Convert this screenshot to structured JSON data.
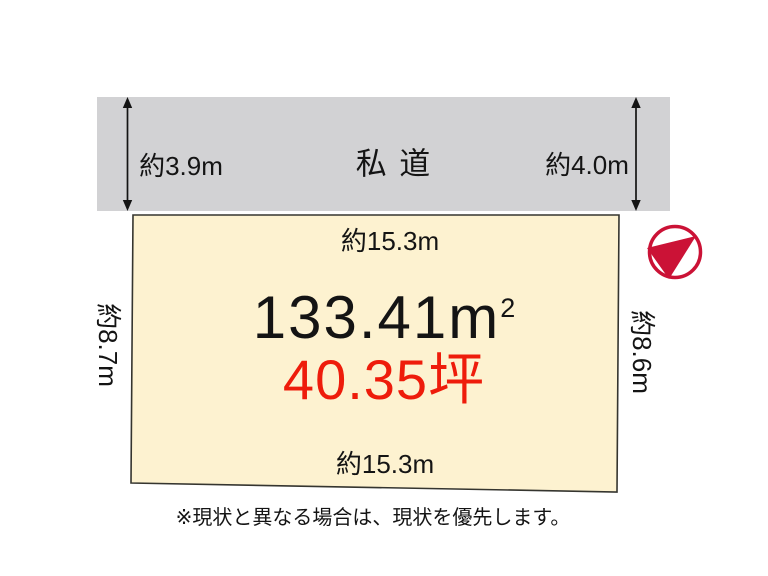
{
  "road": {
    "label": "私 道",
    "width_left": "約3.9m",
    "width_right": "約4.0m"
  },
  "plot": {
    "frontage_top": "約15.3m",
    "frontage_bottom": "約15.3m",
    "depth_left": "約8.7m",
    "depth_right": "約8.6m",
    "area_value": "133.41m",
    "area_exponent": "2",
    "area_tsubo": "40.35坪"
  },
  "note": "※現状と異なる場合は、現状を優先します。",
  "icons": {
    "compass": "north-direction-compass-icon"
  },
  "colors": {
    "road_fill": "#d2d2d4",
    "plot_fill": "#fdf2d0",
    "plot_border": "#35352f",
    "text_black": "#141414",
    "tsubo_red": "#ee1c0b",
    "compass_red": "#cb1236"
  }
}
